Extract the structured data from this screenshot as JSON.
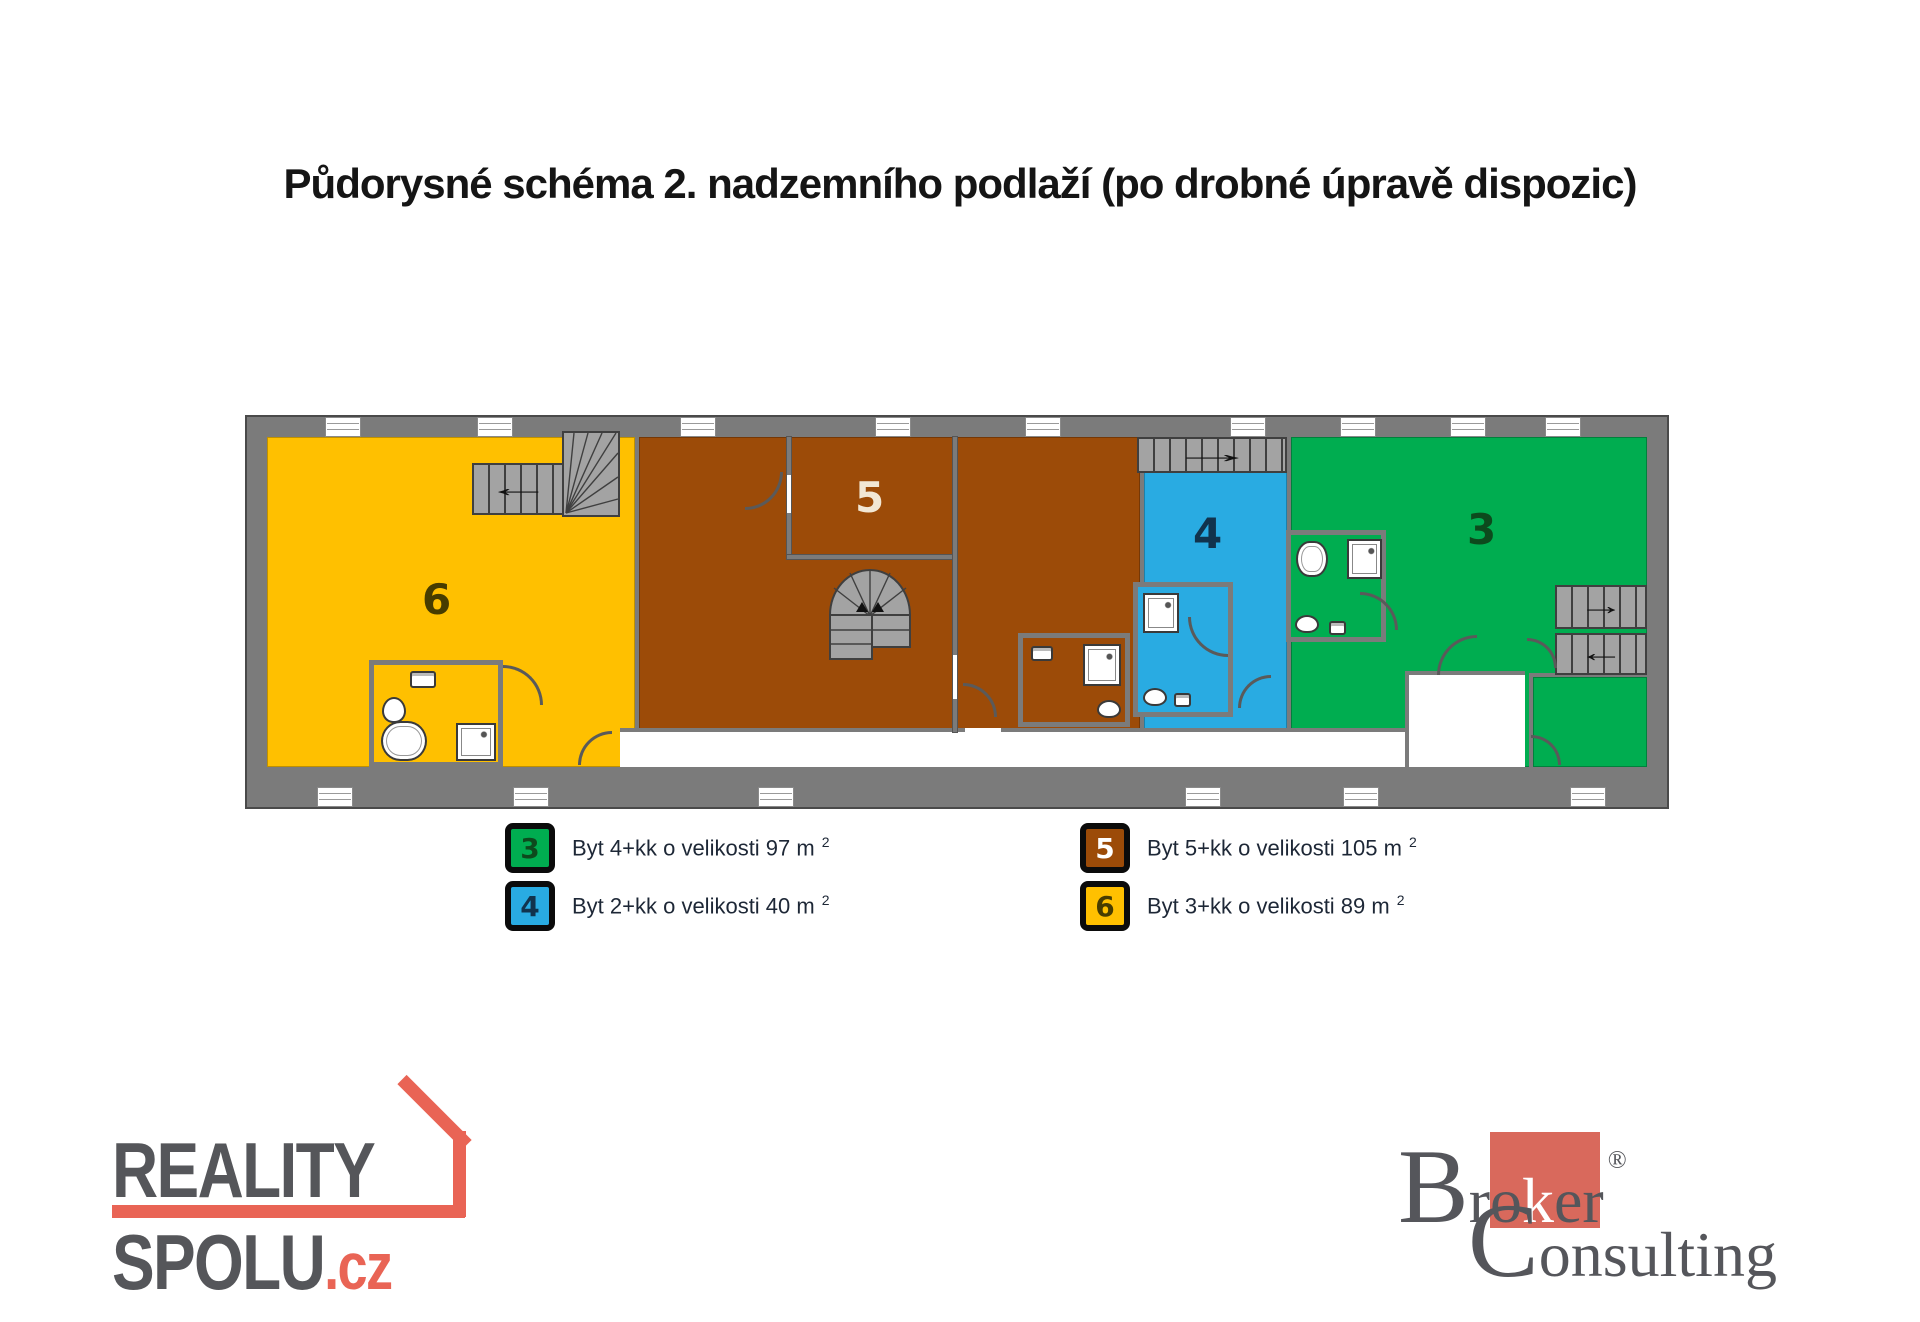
{
  "title": "Půdorysné schéma 2. nadzemního podlaží (po drobné úpravě dispozic)",
  "plan": {
    "apartments": [
      {
        "number": "3",
        "color": "#00AD50",
        "label_color": "#0d4a1d"
      },
      {
        "number": "4",
        "color": "#29ABE2",
        "label_color": "#11334d"
      },
      {
        "number": "5",
        "color": "#9C4B08",
        "label_color": "#f2e7d4"
      },
      {
        "number": "6",
        "color": "#FFC000",
        "label_color": "#473c00"
      }
    ]
  },
  "legend": {
    "items": [
      {
        "number": "3",
        "color": "#00AD50",
        "number_color": "#0d4a1d",
        "label": "Byt 4+kk o velikosti 97 m",
        "sup": "2"
      },
      {
        "number": "4",
        "color": "#29ABE2",
        "number_color": "#11334d",
        "label": "Byt 2+kk o velikosti 40 m",
        "sup": "2"
      },
      {
        "number": "5",
        "color": "#9C4B08",
        "number_color": "#ffffff",
        "label": "Byt 5+kk o velikosti 105 m",
        "sup": "2"
      },
      {
        "number": "6",
        "color": "#FFC000",
        "number_color": "#473c00",
        "label": "Byt 3+kk o velikosti 89 m",
        "sup": "2"
      }
    ]
  },
  "footer": {
    "reality_spolu": {
      "word1": "REALITY",
      "word2": "SPOLU",
      "tld": ".cz",
      "accent_color": "#E96455",
      "text_color": "#55565A"
    },
    "broker_consulting": {
      "b": "B",
      "r": "r",
      "o": "o",
      "k": "k",
      "er": "er",
      "reg": "®",
      "c": "C",
      "onsulting": "onsulting",
      "square_color": "#D9695C",
      "text_color": "#55565B"
    }
  }
}
